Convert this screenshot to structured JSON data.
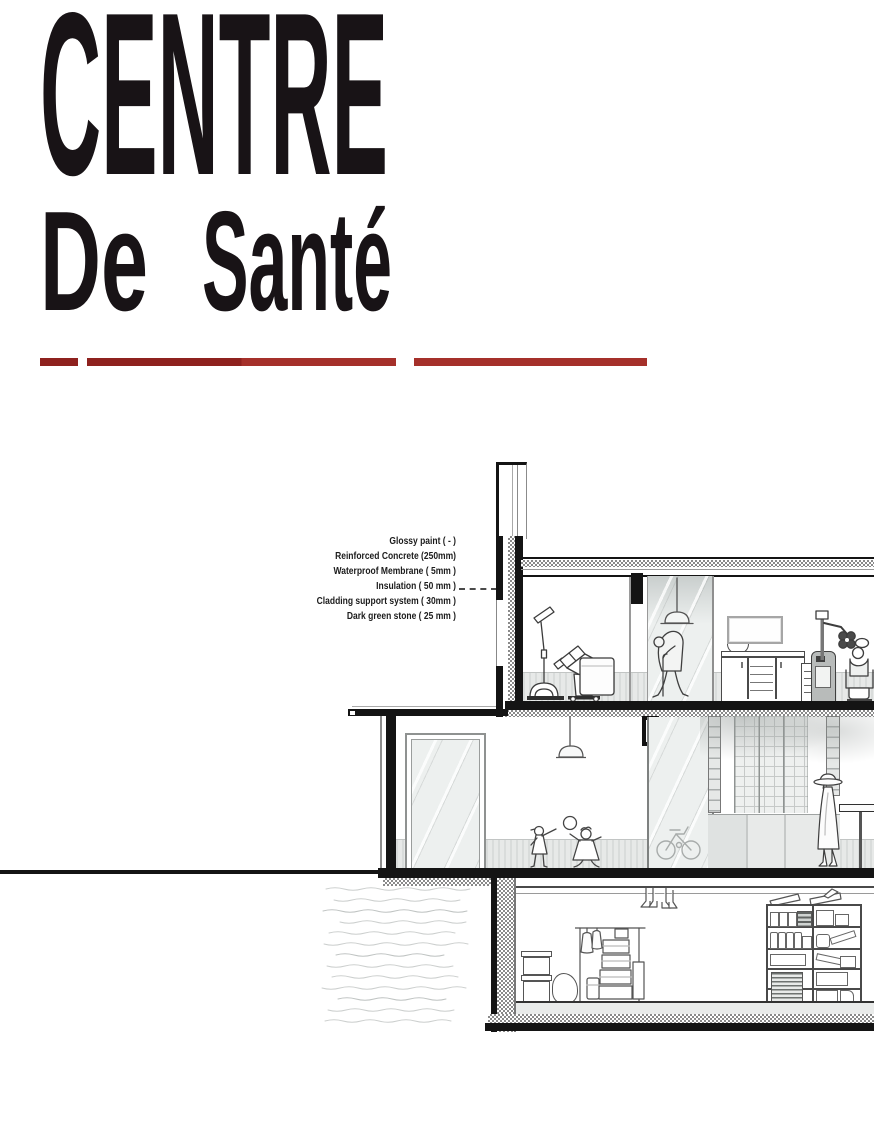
{
  "title": {
    "line1": "CENTRE",
    "line2_word1": "De",
    "line2_word2": "Santé"
  },
  "divider": {
    "color_dark": "#8e211e",
    "color_light": "#a5302a",
    "segment_count": 3
  },
  "annotations": {
    "items": [
      "Glossy paint ( - )",
      "Reinforced Concrete (250mm)",
      "Waterproof Membrane ( 5mm )",
      "Insulation ( 50 mm )",
      "Cladding support system ( 30mm )",
      "Dark green stone ( 25 mm )"
    ]
  },
  "palette": {
    "paper": "#ffffff",
    "ink": "#141414",
    "line_gray": "#4a4a4a",
    "glass": "#edf0ef",
    "wainscot": "#e0e3e2",
    "accent_red": "#9b2722"
  }
}
